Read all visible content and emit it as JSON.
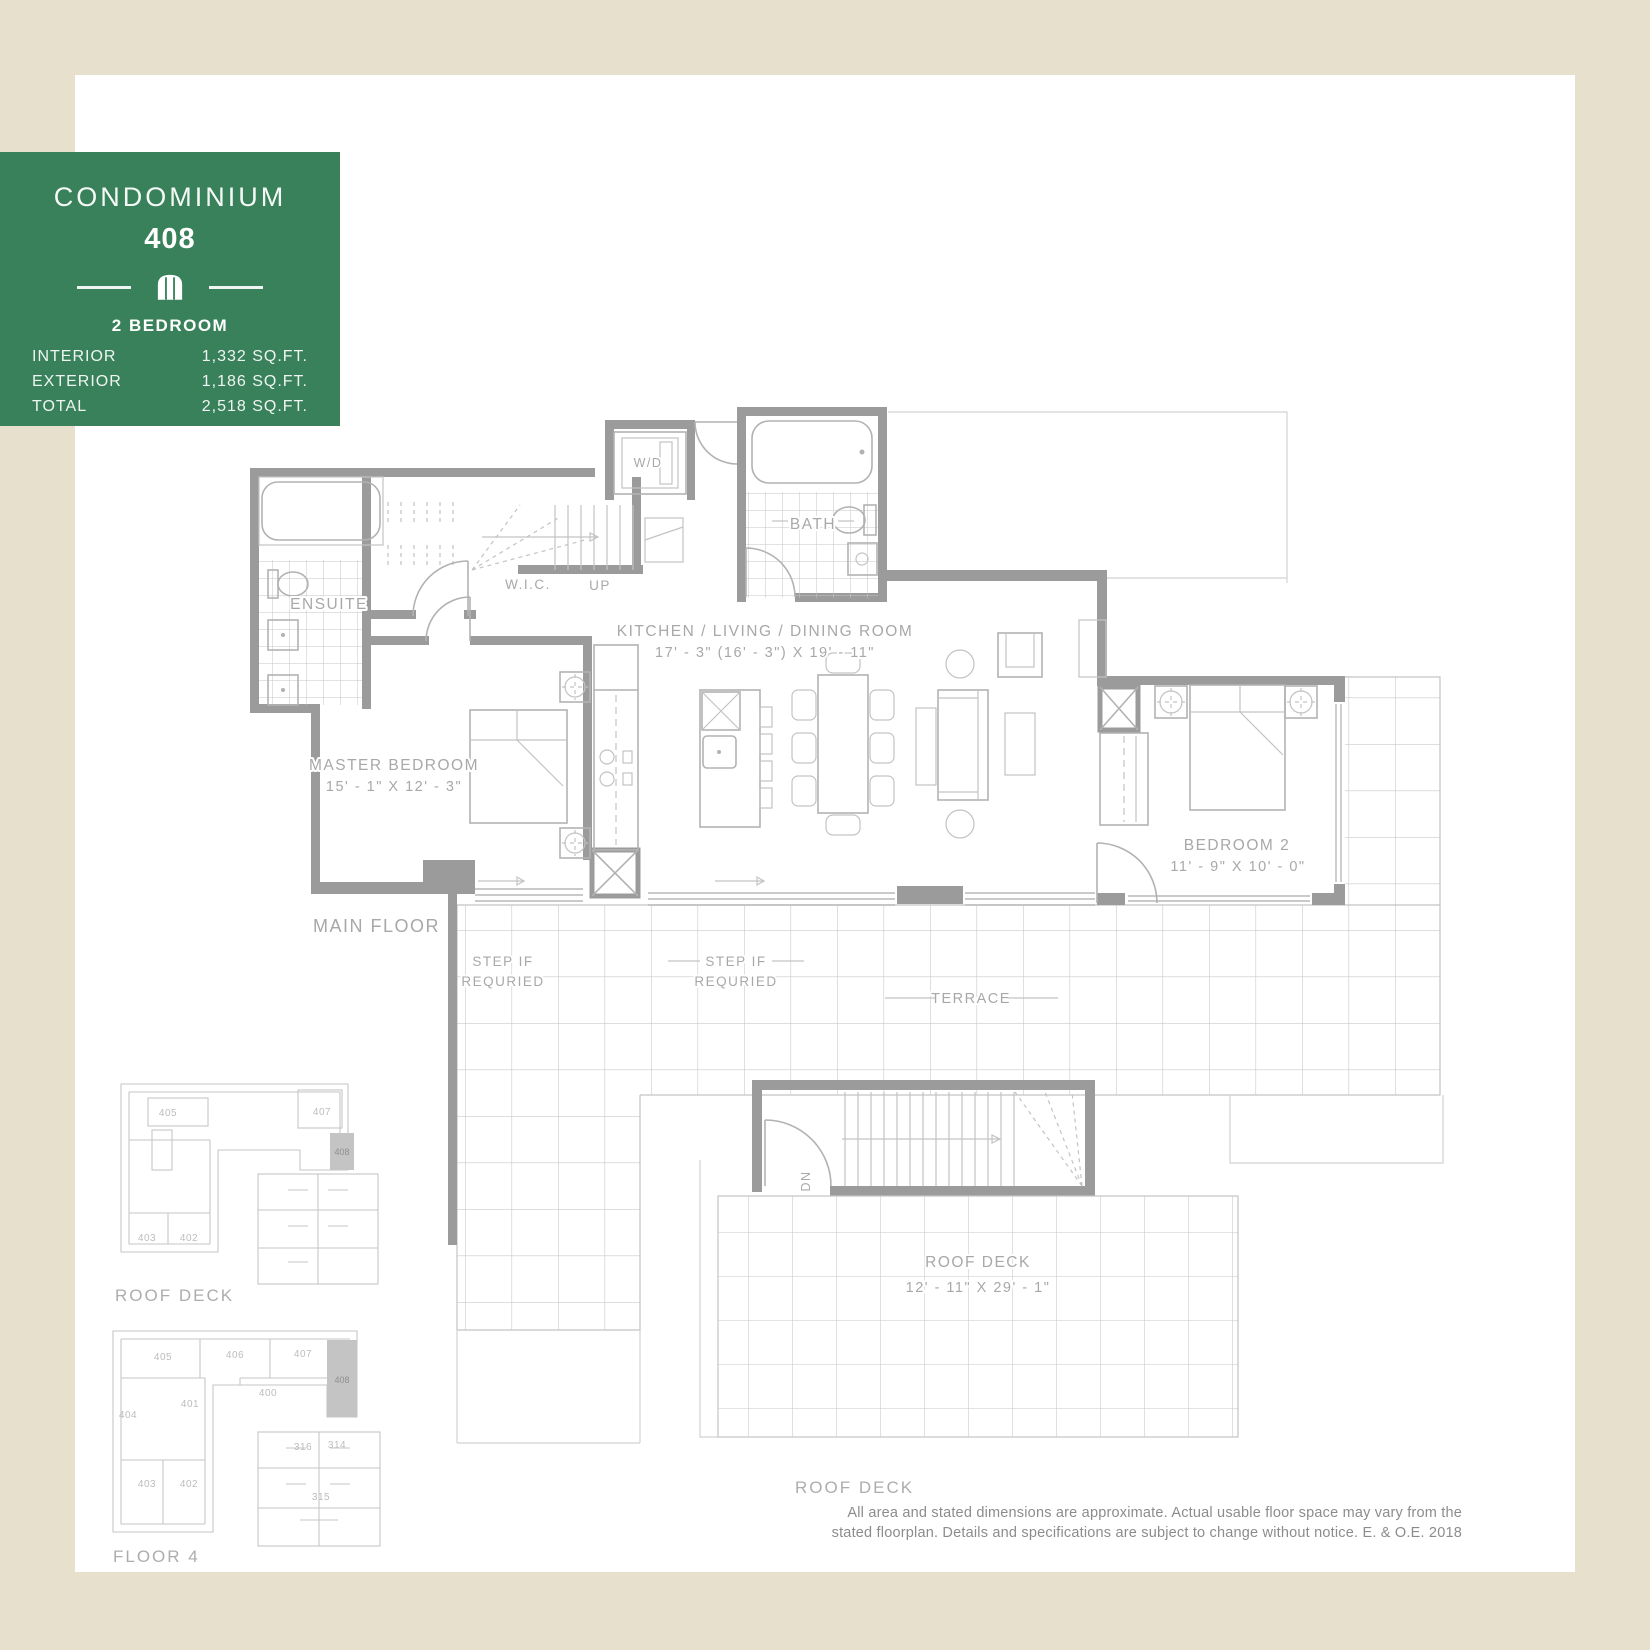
{
  "sheet": {
    "frame_color": "#e7e0cd",
    "info_card": {
      "bg_color": "#38815a",
      "title": "CONDOMINIUM",
      "unit_number": "408",
      "icon": "arched-window-icon",
      "type_label": "2 BEDROOM",
      "stats": [
        {
          "label": "INTERIOR",
          "value": "1,332 SQ.FT."
        },
        {
          "label": "EXTERIOR",
          "value": "1,186 SQ.FT."
        },
        {
          "label": "TOTAL",
          "value": "2,518 SQ.FT."
        }
      ]
    }
  },
  "main_floor": {
    "caption": "MAIN FLOOR",
    "labels": {
      "wd": "W/D",
      "bath": "BATH",
      "ensuite": "ENSUITE",
      "wic": "W.I.C.",
      "up": "UP",
      "kitchen_name": "KITCHEN / LIVING / DINING ROOM",
      "kitchen_dims": "17' - 3\" (16' - 3\") X 19' - 11\"",
      "master_name": "MASTER BEDROOM",
      "master_dims": "15' - 1\" X 12' - 3\"",
      "bedroom2_name": "BEDROOM 2",
      "bedroom2_dims": "11' - 9\" X 10' - 0\"",
      "terrace": "TERRACE",
      "step_line1": "STEP IF",
      "step_line2": "REQURIED"
    }
  },
  "roof_deck": {
    "dn": "DN",
    "name": "ROOF DECK",
    "dims": "12' - 11\" X 29' - 1\"",
    "caption": "ROOF DECK"
  },
  "keyplans": {
    "roof": {
      "caption": "ROOF DECK",
      "highlight": "408",
      "units": [
        "405",
        "407",
        "403",
        "402"
      ]
    },
    "floor4": {
      "caption": "FLOOR 4",
      "highlight": "408",
      "units": [
        "405",
        "406",
        "407",
        "400",
        "401",
        "404",
        "403",
        "402",
        "316",
        "314",
        "315"
      ]
    }
  },
  "disclaimer": {
    "line1": "All area and stated dimensions are approximate. Actual usable floor space may vary from the",
    "line2": "stated floorplan. Details and specifications are subject to change without notice. E. & O.E. 2018"
  }
}
